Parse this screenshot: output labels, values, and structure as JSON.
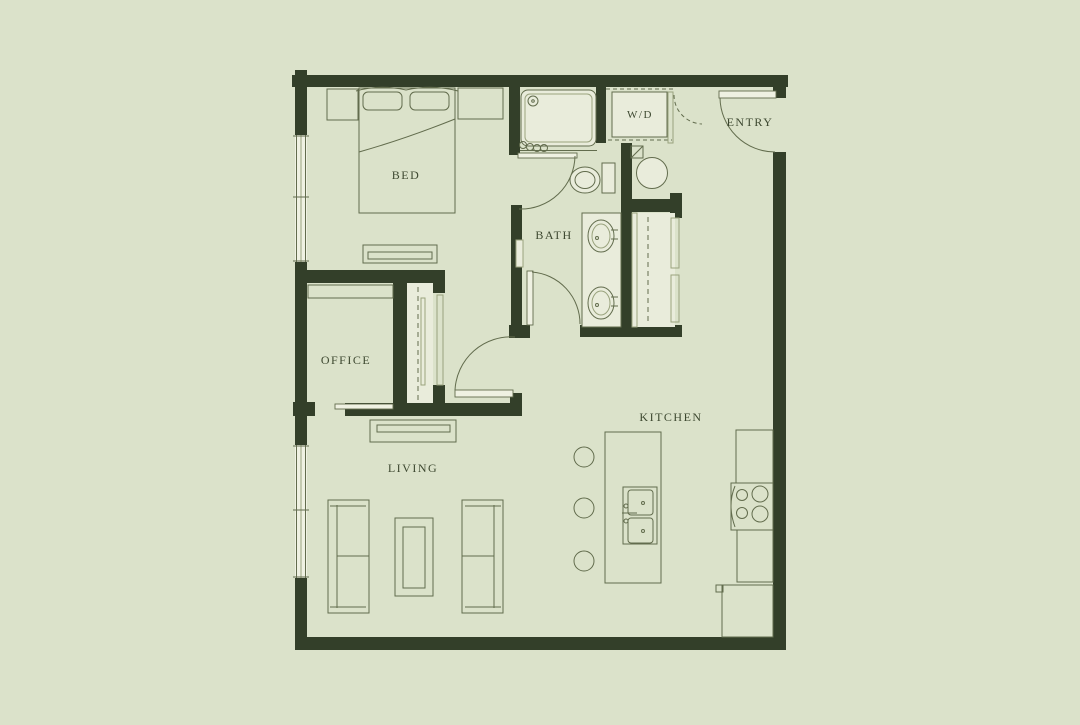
{
  "canvas": {
    "w": 1080,
    "h": 725
  },
  "colors": {
    "bg": "#dbe2ca",
    "wall": "#333f29",
    "line": "#626c4d",
    "light": "#9aa37e",
    "fill_light": "#e9ecdb",
    "fill_bright": "#eff1e2",
    "text": "#3d4830"
  },
  "labels": [
    {
      "name": "room-label-bed",
      "text": "BED",
      "x": 406,
      "y": 179,
      "size": 12
    },
    {
      "name": "room-label-bath",
      "text": "BATH",
      "x": 554,
      "y": 239,
      "size": 12
    },
    {
      "name": "room-label-wd",
      "text": "W/D",
      "x": 640,
      "y": 118,
      "size": 11
    },
    {
      "name": "room-label-entry",
      "text": "ENTRY",
      "x": 750,
      "y": 126,
      "size": 12
    },
    {
      "name": "room-label-office",
      "text": "OFFICE",
      "x": 346,
      "y": 364,
      "size": 12
    },
    {
      "name": "room-label-living",
      "text": "LIVING",
      "x": 413,
      "y": 472,
      "size": 12
    },
    {
      "name": "room-label-kitchen",
      "text": "KITCHEN",
      "x": 671,
      "y": 421,
      "size": 12
    }
  ],
  "walls": [
    [
      292,
      75,
      496,
      12
    ],
    [
      295,
      70,
      12,
      65
    ],
    [
      295,
      262,
      12,
      183
    ],
    [
      295,
      578,
      12,
      72
    ],
    [
      295,
      637,
      491,
      13
    ],
    [
      773,
      152,
      13,
      498
    ],
    [
      773,
      87,
      13,
      11
    ],
    [
      509,
      87,
      11,
      68
    ],
    [
      596,
      87,
      10,
      56
    ],
    [
      621,
      143,
      11,
      187
    ],
    [
      621,
      199,
      61,
      13
    ],
    [
      670,
      193,
      12,
      25
    ],
    [
      580,
      325,
      102,
      12
    ],
    [
      509,
      325,
      21,
      13
    ],
    [
      511,
      205,
      11,
      131
    ],
    [
      295,
      270,
      150,
      13
    ],
    [
      393,
      283,
      14,
      120
    ],
    [
      433,
      283,
      12,
      10
    ],
    [
      433,
      385,
      12,
      18
    ],
    [
      345,
      403,
      177,
      13
    ],
    [
      293,
      402,
      22,
      14
    ],
    [
      510,
      393,
      12,
      22
    ]
  ],
  "elements": [
    {
      "name": "window-bedroom",
      "shapes": [
        {
          "t": "rect",
          "x": 295,
          "y": 135,
          "w": 12,
          "h": 127,
          "f": "fill_bright",
          "s": 0
        },
        {
          "t": "line",
          "x1": 296.5,
          "y1": 135,
          "x2": 296.5,
          "y2": 262
        },
        {
          "t": "line",
          "x1": 301,
          "y1": 135,
          "x2": 301,
          "y2": 262,
          "sc": "light"
        },
        {
          "t": "line",
          "x1": 305.5,
          "y1": 135,
          "x2": 305.5,
          "y2": 262
        },
        {
          "t": "line",
          "x1": 293,
          "y1": 136,
          "x2": 309,
          "y2": 136
        },
        {
          "t": "line",
          "x1": 293,
          "y1": 197,
          "x2": 309,
          "y2": 197
        },
        {
          "t": "line",
          "x1": 293,
          "y1": 261,
          "x2": 309,
          "y2": 261
        }
      ]
    },
    {
      "name": "window-living",
      "shapes": [
        {
          "t": "rect",
          "x": 295,
          "y": 445,
          "w": 12,
          "h": 133,
          "f": "fill_bright",
          "s": 0
        },
        {
          "t": "line",
          "x1": 296.5,
          "y1": 445,
          "x2": 296.5,
          "y2": 578
        },
        {
          "t": "line",
          "x1": 301,
          "y1": 445,
          "x2": 301,
          "y2": 578,
          "sc": "light"
        },
        {
          "t": "line",
          "x1": 305.5,
          "y1": 445,
          "x2": 305.5,
          "y2": 578
        },
        {
          "t": "line",
          "x1": 293,
          "y1": 446,
          "x2": 309,
          "y2": 446
        },
        {
          "t": "line",
          "x1": 293,
          "y1": 510,
          "x2": 309,
          "y2": 510
        },
        {
          "t": "line",
          "x1": 293,
          "y1": 577,
          "x2": 309,
          "y2": 577
        }
      ]
    },
    {
      "name": "entry-door",
      "shapes": [
        {
          "t": "rect",
          "x": 719,
          "y": 91,
          "w": 57,
          "h": 7,
          "f": "fill_bright",
          "s": 0.9
        },
        {
          "t": "path",
          "d": "M720 98 A55 55 0 0 0 775 152"
        }
      ]
    },
    {
      "name": "wet-room-door",
      "shapes": [
        {
          "t": "rect",
          "x": 518,
          "y": 153,
          "w": 59,
          "h": 5,
          "f": "fill_bright",
          "s": 0.9
        },
        {
          "t": "path",
          "d": "M575 156 A54 54 0 0 1 519 209"
        }
      ]
    },
    {
      "name": "bath-door",
      "shapes": [
        {
          "t": "rect",
          "x": 527,
          "y": 271,
          "w": 6,
          "h": 54,
          "f": "fill_bright",
          "s": 0.9
        },
        {
          "t": "path",
          "d": "M532 272 A52 52 0 0 1 580 324"
        }
      ]
    },
    {
      "name": "suite-door",
      "shapes": [
        {
          "t": "rect",
          "x": 455,
          "y": 390,
          "w": 58,
          "h": 7,
          "f": "fill_bright",
          "s": 0.9
        },
        {
          "t": "path",
          "d": "M455 390 A56 56 0 0 1 515 337"
        }
      ]
    },
    {
      "name": "closet-door-dashed",
      "shapes": [
        {
          "t": "path",
          "d": "M674 95 A29 29 0 0 0 702 124",
          "da": "4,3"
        }
      ]
    },
    {
      "name": "shower",
      "shapes": [
        {
          "t": "rect",
          "x": 521,
          "y": 90,
          "w": 75,
          "h": 56,
          "rx": 7,
          "f": "fill_light"
        },
        {
          "t": "rect",
          "x": 525,
          "y": 94,
          "w": 67,
          "h": 48,
          "rx": 5,
          "sc": "light"
        },
        {
          "t": "circle",
          "cx": 533,
          "cy": 101,
          "r": 5
        },
        {
          "t": "circle",
          "cx": 533,
          "cy": 101,
          "r": 1.3
        },
        {
          "t": "circle",
          "cx": 523,
          "cy": 145,
          "r": 3.5
        },
        {
          "t": "circle",
          "cx": 530,
          "cy": 147,
          "r": 3.5
        },
        {
          "t": "circle",
          "cx": 537,
          "cy": 148,
          "r": 3.5
        },
        {
          "t": "circle",
          "cx": 544,
          "cy": 148,
          "r": 3.5
        },
        {
          "t": "line",
          "x1": 520,
          "y1": 150.5,
          "x2": 597,
          "y2": 150.5
        }
      ]
    },
    {
      "name": "washer-dryer",
      "shapes": [
        {
          "t": "rect",
          "x": 612,
          "y": 92,
          "w": 55,
          "h": 45,
          "f": "fill_light"
        },
        {
          "t": "line",
          "x1": 606,
          "y1": 89,
          "x2": 673,
          "y2": 89,
          "da": "4,3"
        },
        {
          "t": "line",
          "x1": 608,
          "y1": 140,
          "x2": 672,
          "y2": 140,
          "da": "4,3"
        }
      ]
    },
    {
      "name": "wd-closet-face",
      "shapes": [
        {
          "t": "rect",
          "x": 668,
          "y": 92,
          "w": 5,
          "h": 51,
          "sc": "light"
        }
      ]
    },
    {
      "name": "toilet",
      "shapes": [
        {
          "t": "rect",
          "x": 602,
          "y": 163,
          "w": 13,
          "h": 30,
          "f": "fill_light"
        },
        {
          "t": "ellipse",
          "cx": 585,
          "cy": 180,
          "rx": 15,
          "ry": 13,
          "f": "fill_light"
        },
        {
          "t": "ellipse",
          "cx": 585,
          "cy": 180,
          "rx": 10,
          "ry": 8.5
        }
      ]
    },
    {
      "name": "round-basin",
      "shapes": [
        {
          "t": "circle",
          "cx": 652,
          "cy": 173,
          "r": 15.5,
          "f": "fill_light"
        }
      ]
    },
    {
      "name": "corner-shelf",
      "shapes": [
        {
          "t": "rect",
          "x": 631,
          "y": 146,
          "w": 12,
          "h": 12
        },
        {
          "t": "line",
          "x1": 631,
          "y1": 158,
          "x2": 643,
          "y2": 146
        }
      ]
    },
    {
      "name": "vanity",
      "shapes": [
        {
          "t": "rect",
          "x": 582,
          "y": 213,
          "w": 39,
          "h": 114,
          "f": "fill_light"
        },
        {
          "t": "ellipse",
          "cx": 601,
          "cy": 236,
          "rx": 13,
          "ry": 16
        },
        {
          "t": "ellipse",
          "cx": 601,
          "cy": 236,
          "rx": 9,
          "ry": 12,
          "sc": "light"
        },
        {
          "t": "circle",
          "cx": 597,
          "cy": 238,
          "r": 1.5
        },
        {
          "t": "line",
          "x1": 611,
          "y1": 230,
          "x2": 618,
          "y2": 230
        },
        {
          "t": "line",
          "x1": 611,
          "y1": 239,
          "x2": 618,
          "y2": 239
        },
        {
          "t": "ellipse",
          "cx": 601,
          "cy": 303,
          "rx": 13,
          "ry": 16
        },
        {
          "t": "ellipse",
          "cx": 601,
          "cy": 303,
          "rx": 9,
          "ry": 12,
          "sc": "light"
        },
        {
          "t": "circle",
          "cx": 597,
          "cy": 305,
          "r": 1.5
        },
        {
          "t": "line",
          "x1": 611,
          "y1": 297,
          "x2": 618,
          "y2": 297
        },
        {
          "t": "line",
          "x1": 611,
          "y1": 306,
          "x2": 618,
          "y2": 306
        }
      ]
    },
    {
      "name": "entry-closet",
      "shapes": [
        {
          "t": "rect",
          "x": 632,
          "y": 213,
          "w": 43,
          "h": 114,
          "f": "fill_light",
          "s": 0
        },
        {
          "t": "rect",
          "x": 632,
          "y": 213,
          "w": 5,
          "h": 114,
          "sc": "light"
        },
        {
          "t": "rect",
          "x": 671,
          "y": 218,
          "w": 8,
          "h": 50,
          "sc": "light"
        },
        {
          "t": "rect",
          "x": 671,
          "y": 275,
          "w": 8,
          "h": 47,
          "sc": "light"
        },
        {
          "t": "line",
          "x1": 648,
          "y1": 217,
          "x2": 648,
          "y2": 325,
          "da": "5,4"
        }
      ]
    },
    {
      "name": "wallb-niche",
      "shapes": [
        {
          "t": "rect",
          "x": 516,
          "y": 240,
          "w": 7,
          "h": 27,
          "f": "fill_light",
          "sc": "light"
        }
      ]
    },
    {
      "name": "office-closet",
      "shapes": [
        {
          "t": "rect",
          "x": 407,
          "y": 283,
          "w": 26,
          "h": 120,
          "f": "fill_light",
          "s": 0
        },
        {
          "t": "line",
          "x1": 418,
          "y1": 287,
          "x2": 418,
          "y2": 400,
          "da": "5,4"
        },
        {
          "t": "rect",
          "x": 421,
          "y": 298,
          "w": 4,
          "h": 87,
          "sc": "light"
        }
      ]
    },
    {
      "name": "nook-closet-face",
      "shapes": [
        {
          "t": "rect",
          "x": 437,
          "y": 295,
          "w": 6,
          "h": 90,
          "sc": "light"
        }
      ]
    },
    {
      "name": "office-pocket-door",
      "shapes": [
        {
          "t": "rect",
          "x": 335,
          "y": 404,
          "w": 58,
          "h": 5,
          "f": "fill_bright",
          "s": 0.9
        }
      ]
    },
    {
      "name": "office-desk",
      "shapes": [
        {
          "t": "rect",
          "x": 308,
          "y": 285,
          "w": 85,
          "h": 13
        }
      ]
    },
    {
      "name": "bed",
      "shapes": [
        {
          "t": "rect",
          "x": 359,
          "y": 88,
          "w": 96,
          "h": 125
        },
        {
          "t": "path",
          "d": "M356 91 Q380 84 406 90 Q432 84 458 91"
        },
        {
          "t": "rect",
          "x": 363,
          "y": 92,
          "w": 39,
          "h": 18,
          "rx": 5
        },
        {
          "t": "rect",
          "x": 410,
          "y": 92,
          "w": 39,
          "h": 18,
          "rx": 5
        },
        {
          "t": "path",
          "d": "M359 152 Q405 139 455 119"
        }
      ]
    },
    {
      "name": "nightstand-left",
      "shapes": [
        {
          "t": "rect",
          "x": 327,
          "y": 89,
          "w": 31,
          "h": 31
        }
      ]
    },
    {
      "name": "nightstand-right",
      "shapes": [
        {
          "t": "rect",
          "x": 458,
          "y": 88,
          "w": 45,
          "h": 31
        }
      ]
    },
    {
      "name": "dresser",
      "shapes": [
        {
          "t": "rect",
          "x": 363,
          "y": 245,
          "w": 74,
          "h": 18
        },
        {
          "t": "rect",
          "x": 368,
          "y": 252,
          "w": 64,
          "h": 7
        }
      ]
    },
    {
      "name": "media-console",
      "shapes": [
        {
          "t": "rect",
          "x": 370,
          "y": 420,
          "w": 86,
          "h": 22
        },
        {
          "t": "rect",
          "x": 377,
          "y": 425,
          "w": 73,
          "h": 7
        }
      ]
    },
    {
      "name": "sofa-left",
      "shapes": [
        {
          "t": "rect",
          "x": 328,
          "y": 500,
          "w": 41,
          "h": 113
        },
        {
          "t": "line",
          "x1": 337,
          "y1": 505,
          "x2": 337,
          "y2": 608
        },
        {
          "t": "line",
          "x1": 330,
          "y1": 506,
          "x2": 366,
          "y2": 506
        },
        {
          "t": "line",
          "x1": 330,
          "y1": 607,
          "x2": 366,
          "y2": 607
        },
        {
          "t": "line",
          "x1": 337,
          "y1": 556,
          "x2": 369,
          "y2": 556
        }
      ]
    },
    {
      "name": "sofa-right",
      "shapes": [
        {
          "t": "rect",
          "x": 462,
          "y": 500,
          "w": 41,
          "h": 113
        },
        {
          "t": "line",
          "x1": 494,
          "y1": 505,
          "x2": 494,
          "y2": 608
        },
        {
          "t": "line",
          "x1": 465,
          "y1": 506,
          "x2": 501,
          "y2": 506
        },
        {
          "t": "line",
          "x1": 465,
          "y1": 607,
          "x2": 501,
          "y2": 607
        },
        {
          "t": "line",
          "x1": 462,
          "y1": 556,
          "x2": 494,
          "y2": 556
        }
      ]
    },
    {
      "name": "coffee-table",
      "shapes": [
        {
          "t": "rect",
          "x": 395,
          "y": 518,
          "w": 38,
          "h": 78
        },
        {
          "t": "rect",
          "x": 403,
          "y": 527,
          "w": 22,
          "h": 61
        }
      ]
    },
    {
      "name": "kitchen-island",
      "shapes": [
        {
          "t": "rect",
          "x": 605,
          "y": 432,
          "w": 56,
          "h": 151
        }
      ]
    },
    {
      "name": "island-sink",
      "shapes": [
        {
          "t": "rect",
          "x": 623,
          "y": 487,
          "w": 34,
          "h": 57
        },
        {
          "t": "rect",
          "x": 628,
          "y": 490,
          "w": 25,
          "h": 25,
          "rx": 3
        },
        {
          "t": "rect",
          "x": 628,
          "y": 518,
          "w": 25,
          "h": 25,
          "rx": 3
        },
        {
          "t": "circle",
          "cx": 643,
          "cy": 503,
          "r": 1.5
        },
        {
          "t": "circle",
          "cx": 643,
          "cy": 531,
          "r": 1.5
        },
        {
          "t": "circle",
          "cx": 626,
          "cy": 506,
          "r": 2
        },
        {
          "t": "circle",
          "cx": 626,
          "cy": 521,
          "r": 2
        },
        {
          "t": "line",
          "x1": 622,
          "y1": 513,
          "x2": 637,
          "y2": 513
        }
      ]
    },
    {
      "name": "bar-stools",
      "shapes": [
        {
          "t": "circle",
          "cx": 584,
          "cy": 457,
          "r": 10
        },
        {
          "t": "circle",
          "cx": 584,
          "cy": 508,
          "r": 10
        },
        {
          "t": "circle",
          "cx": 584,
          "cy": 561,
          "r": 10
        }
      ]
    },
    {
      "name": "counter-upper",
      "shapes": [
        {
          "t": "rect",
          "x": 736,
          "y": 430,
          "w": 37,
          "h": 53
        }
      ]
    },
    {
      "name": "stove",
      "shapes": [
        {
          "t": "rect",
          "x": 731,
          "y": 483,
          "w": 42,
          "h": 47
        },
        {
          "t": "circle",
          "cx": 742,
          "cy": 495,
          "r": 5.5
        },
        {
          "t": "circle",
          "cx": 760,
          "cy": 494,
          "r": 8
        },
        {
          "t": "circle",
          "cx": 742,
          "cy": 513,
          "r": 5.5
        },
        {
          "t": "circle",
          "cx": 760,
          "cy": 514,
          "r": 8
        },
        {
          "t": "path",
          "d": "M735 486 Q727 505 735 527"
        }
      ]
    },
    {
      "name": "counter-lower",
      "shapes": [
        {
          "t": "rect",
          "x": 737,
          "y": 530,
          "w": 36,
          "h": 52
        }
      ]
    },
    {
      "name": "fridge",
      "shapes": [
        {
          "t": "rect",
          "x": 722,
          "y": 585,
          "w": 51,
          "h": 52
        },
        {
          "t": "rect",
          "x": 716,
          "y": 585,
          "w": 7,
          "h": 7
        }
      ]
    }
  ]
}
